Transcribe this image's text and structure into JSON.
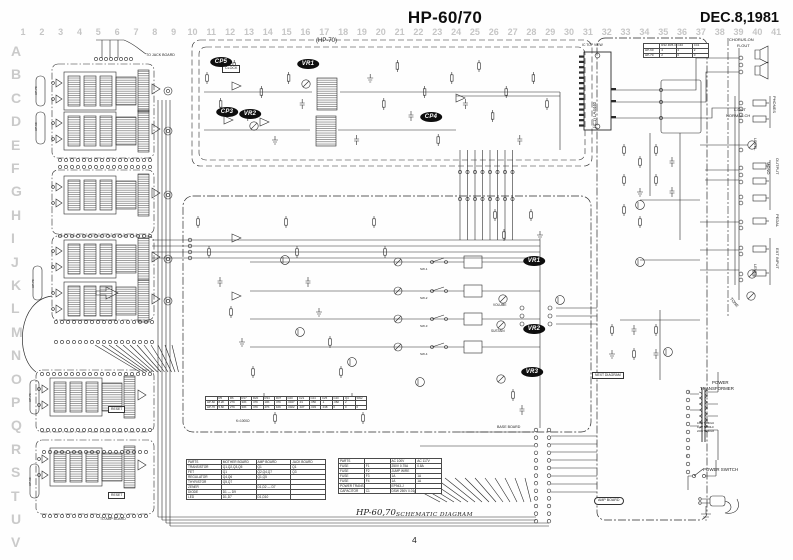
{
  "header": {
    "title": "HP-60/70",
    "date": "DEC.8,1981"
  },
  "footer": {
    "model": "HP-60,70",
    "caption": "SCHEMATIC DIAGRAM",
    "page": "4"
  },
  "grid": {
    "cols": [
      "1",
      "2",
      "3",
      "4",
      "5",
      "6",
      "7",
      "8",
      "9",
      "10",
      "11",
      "12",
      "13",
      "14",
      "15",
      "16",
      "17",
      "18",
      "19",
      "20",
      "21",
      "22",
      "23",
      "24",
      "25",
      "26",
      "27",
      "28",
      "29",
      "30",
      "31",
      "32",
      "33",
      "34",
      "35",
      "36",
      "37",
      "38",
      "39",
      "40",
      "41"
    ],
    "rows": [
      "A",
      "B",
      "C",
      "D",
      "E",
      "F",
      "G",
      "H",
      "I",
      "J",
      "K",
      "L",
      "M",
      "N",
      "O",
      "P",
      "Q",
      "R",
      "S",
      "T",
      "U",
      "V"
    ]
  },
  "badges": [
    {
      "label": "CP5",
      "x": 221,
      "y": 62
    },
    {
      "label": "CP3",
      "x": 227,
      "y": 112
    },
    {
      "label": "VR2",
      "x": 250,
      "y": 114
    },
    {
      "label": "VR1",
      "x": 308,
      "y": 64
    },
    {
      "label": "CP4",
      "x": 431,
      "y": 117
    },
    {
      "label": "VR1",
      "x": 534,
      "y": 261
    },
    {
      "label": "VR2",
      "x": 534,
      "y": 329
    },
    {
      "label": "VR3",
      "x": 532,
      "y": 372
    }
  ],
  "labels": [
    {
      "t": "(HP-70)",
      "x": 316,
      "y": 38,
      "s": 6
    },
    {
      "t": "TO JACK BOARD",
      "x": 146,
      "y": 54,
      "s": 3.6
    },
    {
      "t": "CLOCK",
      "x": 222,
      "y": 65,
      "s": 3.6,
      "b": "rect"
    },
    {
      "t": "IC TOP VIEW",
      "x": 582,
      "y": 44,
      "s": 3.4
    },
    {
      "t": "(IC1) LA4440",
      "x": 593,
      "y": 128,
      "s": 4.4,
      "r": -90
    },
    {
      "t": "CHORUS-ON",
      "x": 729,
      "y": 38,
      "s": 4
    },
    {
      "t": "R-OUT",
      "x": 737,
      "y": 44,
      "s": 4
    },
    {
      "t": "L-OUT",
      "x": 734,
      "y": 108,
      "s": 4
    },
    {
      "t": "NORMAL-CH",
      "x": 726,
      "y": 114,
      "s": 4
    },
    {
      "t": "PHONES",
      "x": 776,
      "y": 96,
      "s": 4,
      "r": 90
    },
    {
      "t": "LEVEL",
      "x": 757,
      "y": 138,
      "s": 4,
      "r": 90
    },
    {
      "t": "MONO",
      "x": 770,
      "y": 162,
      "s": 4,
      "r": 90
    },
    {
      "t": "OUTPUT",
      "x": 779,
      "y": 158,
      "s": 4,
      "r": 90
    },
    {
      "t": "PEDAL",
      "x": 779,
      "y": 214,
      "s": 4,
      "r": 90
    },
    {
      "t": "EXT INPUT",
      "x": 779,
      "y": 248,
      "s": 4,
      "r": 90
    },
    {
      "t": "LEVEL",
      "x": 757,
      "y": 264,
      "s": 4,
      "r": 90
    },
    {
      "t": "TONE",
      "x": 732,
      "y": 297,
      "s": 4,
      "r": 50
    },
    {
      "t": "POWER",
      "x": 712,
      "y": 381,
      "s": 4.4
    },
    {
      "t": "TRANSFORMER",
      "x": 700,
      "y": 387,
      "s": 4.4
    },
    {
      "t": "POWER SWITCH",
      "x": 703,
      "y": 468,
      "s": 4.4
    },
    {
      "t": "RESET",
      "x": 108,
      "y": 406,
      "s": 3.4,
      "b": "rect"
    },
    {
      "t": "RESET",
      "x": 108,
      "y": 492,
      "s": 3.4,
      "b": "rect"
    },
    {
      "t": "TO AMP BOARD",
      "x": 100,
      "y": 518,
      "s": 3.4
    },
    {
      "t": "AMP BOARD",
      "x": 594,
      "y": 497,
      "s": 3.6,
      "b": "pill"
    },
    {
      "t": "BASE BOARD",
      "x": 497,
      "y": 426,
      "s": 3.6
    },
    {
      "t": "VOLUME",
      "x": 493,
      "y": 304,
      "s": 3.2
    },
    {
      "t": "SUSTAIN",
      "x": 491,
      "y": 330,
      "s": 3.2
    },
    {
      "t": "NEXT DIAGRAM",
      "x": 592,
      "y": 372,
      "s": 3.4,
      "b": "rect"
    },
    {
      "t": "K=1000Ω",
      "x": 236,
      "y": 420,
      "s": 3.2
    },
    {
      "t": "SW-1",
      "x": 420,
      "y": 268,
      "s": 3
    },
    {
      "t": "SW-2",
      "x": 420,
      "y": 297,
      "s": 3
    },
    {
      "t": "SW-3",
      "x": 420,
      "y": 325,
      "s": 3
    },
    {
      "t": "SW-4",
      "x": 420,
      "y": 353,
      "s": 3
    },
    {
      "t": "100V 50/60Hz",
      "x": 697,
      "y": 423,
      "s": 2.7
    },
    {
      "t": "117V 50/60Hz",
      "x": 697,
      "y": 427,
      "s": 2.7
    },
    {
      "t": "220V 50/60Hz",
      "x": 697,
      "y": 431,
      "s": 2.7
    },
    {
      "t": "HP-70",
      "x": 35,
      "y": 95,
      "s": 3,
      "r": -90
    },
    {
      "t": "HP-60",
      "x": 35,
      "y": 131,
      "s": 3,
      "r": -90
    },
    {
      "t": "HP-70",
      "x": 32,
      "y": 288,
      "s": 3,
      "r": -90
    },
    {
      "t": "HP-70",
      "x": 29,
      "y": 402,
      "s": 3,
      "r": -90
    },
    {
      "t": "HP-60",
      "x": 29,
      "y": 486,
      "s": 3,
      "r": -90
    }
  ],
  "tables": {
    "location": {
      "headers": [
        "PARTS",
        "MOTHER BOARD",
        "AMP BOARD",
        "JACK BOARD"
      ],
      "rows": [
        [
          "TRANSISTOR",
          "Q1,Q2,Q3,Q5",
          "Q1",
          "Q1"
        ],
        [
          "FET",
          "Q1",
          "Q2,Q4,Q7",
          "Q3"
        ],
        [
          "REGULATOR",
          "Q4,Q6",
          "Q1,Q5",
          ""
        ],
        [
          "THYRISTOR",
          "Q5,Q7",
          "",
          ""
        ],
        [
          "ZENER",
          "",
          "D1,D2 — D7",
          ""
        ],
        [
          "DIODE",
          "D1 — D9",
          "",
          ""
        ],
        [
          "LED",
          "D1,D7",
          "D1,D10",
          ""
        ]
      ]
    },
    "ac": {
      "headers": [
        "PARTS",
        "",
        "AC 100V",
        "AC 117V"
      ],
      "rows": [
        [
          "FUSE",
          "F1",
          "250V 0.75A",
          "0.8A"
        ],
        [
          "FUSE",
          "F2",
          "JUMP WIRE",
          ""
        ],
        [
          "FUSE",
          "F3",
          "1A",
          "1A"
        ],
        [
          "FUSE",
          "F4",
          "1A",
          "1A"
        ],
        [
          "POWER TRANS",
          "",
          "EP943-J",
          ""
        ],
        [
          "CAPACITOR",
          "C1",
          "DSW 250V 0.01µ",
          ""
        ]
      ]
    },
    "diff": {
      "headers": [
        "",
        "R5",
        "R6",
        "R17",
        "R20",
        "R34",
        "R37",
        "C20",
        "C21",
        "C24",
        "C25",
        "C40",
        "Q4",
        "SW2"
      ],
      "rows": [
        [
          "HP-60",
          "8.2K",
          "27K",
          "33K",
          "47K",
          "10K",
          "47K",
          ".0047",
          ".01",
          ".056",
          ".1",
          ".082",
          "2",
          ""
        ],
        [
          "HP-70",
          "5.6K",
          "27K",
          "33K",
          "47K",
          "47K",
          "10K",
          ".0022",
          ".027",
          ".033",
          ".018",
          "0",
          "0",
          "0"
        ]
      ]
    },
    "mini": {
      "headers": [
        "",
        "R32·R35·C31",
        "C40",
        "C41"
      ],
      "rows": [
        [
          "HP-60",
          "4",
          "2",
          "2"
        ],
        [
          "HP-70",
          "2",
          "0",
          "0"
        ]
      ]
    }
  },
  "colors": {
    "ink": "#2a2a2a",
    "ruler": "#c6c6c6",
    "badge_bg": "#0e0e0e"
  }
}
